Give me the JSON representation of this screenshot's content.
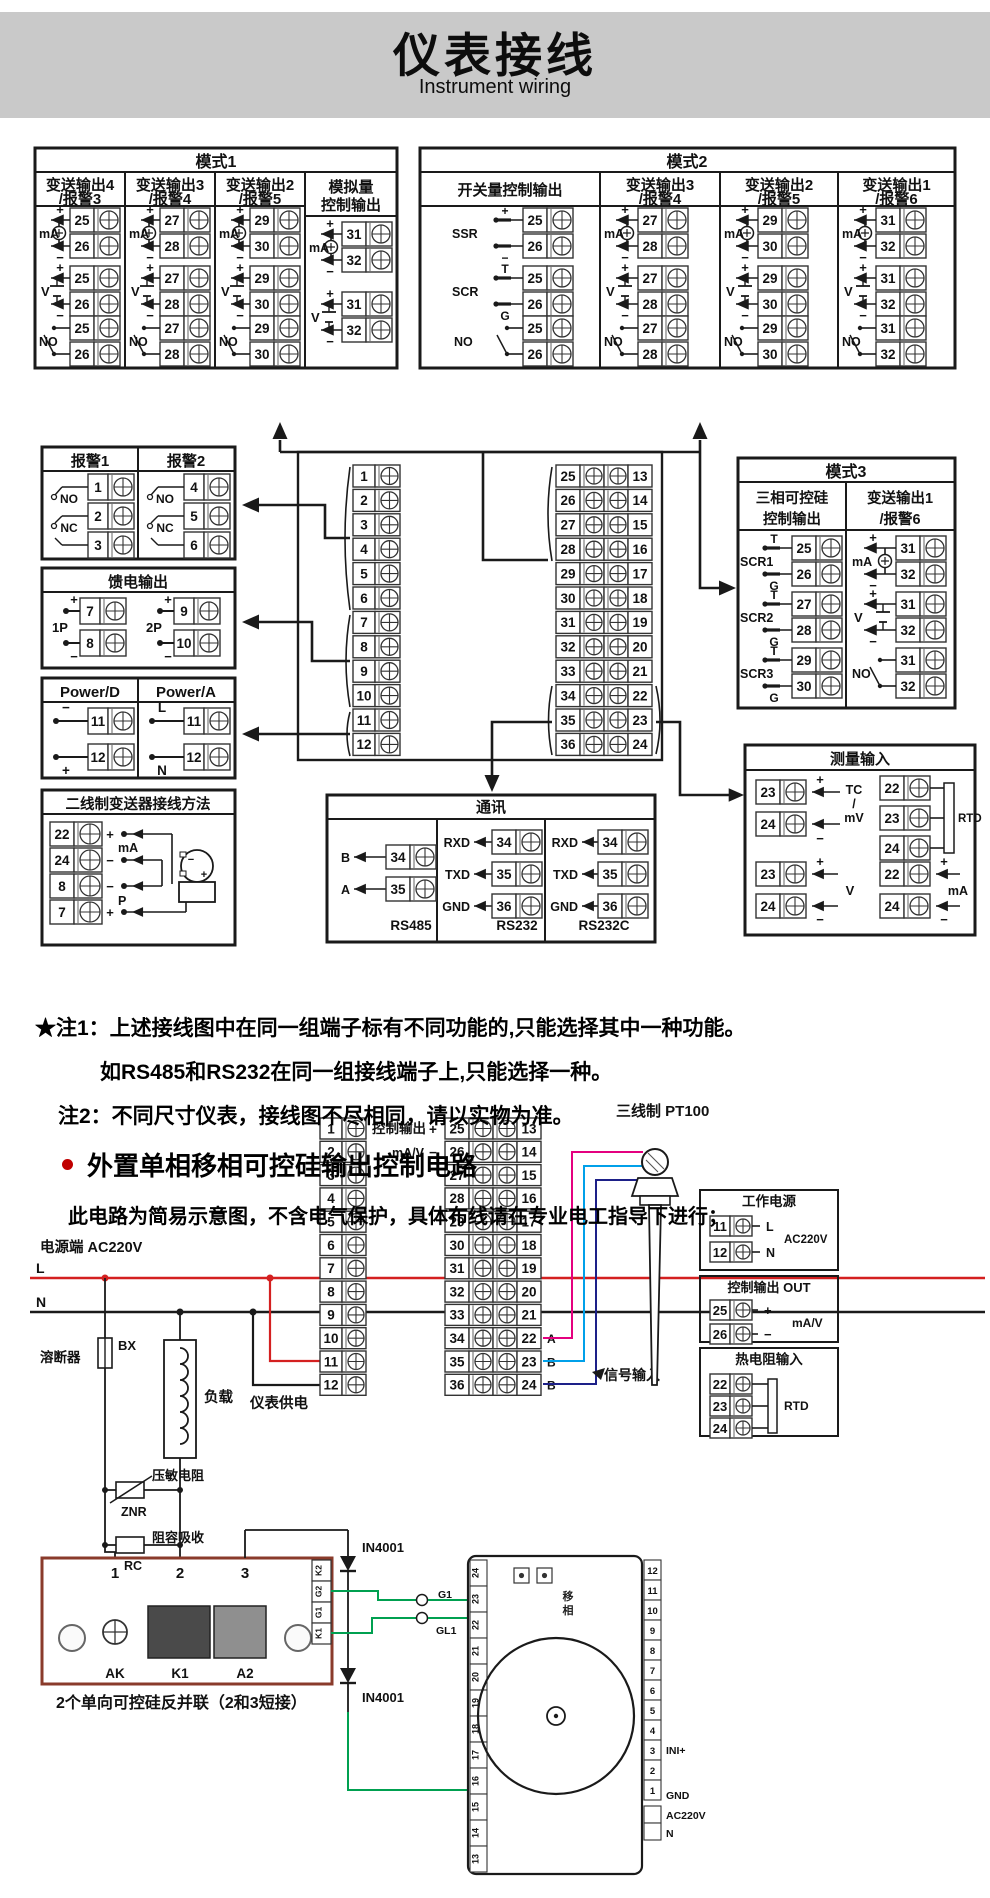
{
  "header": {
    "title": "仪表接线",
    "subtitle": "Instrument wiring"
  },
  "syms": {
    "plus": "+",
    "minus": "−",
    "t": "T",
    "g": "G"
  },
  "mode1": {
    "title": "模式1",
    "cols": [
      {
        "title": [
          "变送输出4",
          "/报警3"
        ],
        "groups": [
          {
            "sym": "mA",
            "t": [
              "25",
              "26"
            ]
          },
          {
            "sym": "V",
            "t": [
              "25",
              "26"
            ]
          },
          {
            "sym": "NO",
            "t": [
              "25",
              "26"
            ]
          }
        ]
      },
      {
        "title": [
          "变送输出3",
          "/报警4"
        ],
        "groups": [
          {
            "sym": "mA",
            "t": [
              "27",
              "28"
            ]
          },
          {
            "sym": "V",
            "t": [
              "27",
              "28"
            ]
          },
          {
            "sym": "NO",
            "t": [
              "27",
              "28"
            ]
          }
        ]
      },
      {
        "title": [
          "变送输出2",
          "/报警5"
        ],
        "groups": [
          {
            "sym": "mA",
            "t": [
              "29",
              "30"
            ]
          },
          {
            "sym": "V",
            "t": [
              "29",
              "30"
            ]
          },
          {
            "sym": "NO",
            "t": [
              "29",
              "30"
            ]
          }
        ]
      },
      {
        "title": [
          "模拟量",
          "控制输出"
        ],
        "groups": [
          {
            "sym": "mA",
            "t": [
              "31",
              "32"
            ]
          },
          {
            "sym": "V",
            "t": [
              "31",
              "32"
            ]
          }
        ]
      }
    ]
  },
  "mode2": {
    "title": "模式2",
    "cols": [
      {
        "title": [
          "开关量控制输出"
        ],
        "groups": [
          {
            "sym": "SSR",
            "t": [
              "25",
              "26"
            ]
          },
          {
            "sym": "SCR",
            "t": [
              "25",
              "26"
            ]
          },
          {
            "sym": "NO",
            "t": [
              "25",
              "26"
            ]
          }
        ]
      },
      {
        "title": [
          "变送输出3",
          "/报警4"
        ],
        "groups": [
          {
            "sym": "mA",
            "t": [
              "27",
              "28"
            ]
          },
          {
            "sym": "V",
            "t": [
              "27",
              "28"
            ]
          },
          {
            "sym": "NO",
            "t": [
              "27",
              "28"
            ]
          }
        ]
      },
      {
        "title": [
          "变送输出2",
          "/报警5"
        ],
        "groups": [
          {
            "sym": "mA",
            "t": [
              "29",
              "30"
            ]
          },
          {
            "sym": "V",
            "t": [
              "29",
              "30"
            ]
          },
          {
            "sym": "NO",
            "t": [
              "29",
              "30"
            ]
          }
        ]
      },
      {
        "title": [
          "变送输出1",
          "/报警6"
        ],
        "groups": [
          {
            "sym": "mA",
            "t": [
              "31",
              "32"
            ]
          },
          {
            "sym": "V",
            "t": [
              "31",
              "32"
            ]
          },
          {
            "sym": "NO",
            "t": [
              "31",
              "32"
            ]
          }
        ]
      }
    ]
  },
  "mode3": {
    "title": "模式3",
    "cols": [
      {
        "title": [
          "三相可控硅",
          "控制输出"
        ],
        "groups": [
          {
            "sym": "SCR1",
            "t": [
              "25",
              "26"
            ]
          },
          {
            "sym": "SCR2",
            "t": [
              "27",
              "28"
            ]
          },
          {
            "sym": "SCR3",
            "t": [
              "29",
              "30"
            ]
          }
        ]
      },
      {
        "title": [
          "变送输出1",
          "/报警6"
        ],
        "groups": [
          {
            "sym": "mA",
            "t": [
              "31",
              "32"
            ]
          },
          {
            "sym": "V",
            "t": [
              "31",
              "32"
            ]
          },
          {
            "sym": "NO",
            "t": [
              "31",
              "32"
            ]
          }
        ]
      }
    ]
  },
  "alarm": {
    "cols": [
      {
        "title": "报警1",
        "t": [
          "1",
          "2",
          "3"
        ]
      },
      {
        "title": "报警2",
        "t": [
          "4",
          "5",
          "6"
        ]
      }
    ],
    "no": "NO",
    "nc": "NC"
  },
  "feed": {
    "title": "馈电输出",
    "groups": [
      {
        "label": "1P",
        "t": [
          "7",
          "8"
        ]
      },
      {
        "label": "2P",
        "t": [
          "9",
          "10"
        ]
      }
    ]
  },
  "power": {
    "cols": [
      {
        "title": "Power/D",
        "rows": [
          [
            "−",
            "11"
          ],
          [
            "+",
            "12"
          ]
        ]
      },
      {
        "title": "Power/A",
        "rows": [
          [
            "L",
            "11"
          ],
          [
            "N",
            "12"
          ]
        ]
      }
    ]
  },
  "twowire": {
    "title": "二线制变送器接线方法",
    "rows": [
      [
        "22",
        "+"
      ],
      [
        "24",
        "−"
      ],
      [
        "8",
        "−"
      ],
      [
        "7",
        "+"
      ]
    ],
    "mid": [
      "mA",
      "P"
    ]
  },
  "block": {
    "left": [
      "1",
      "2",
      "3",
      "4",
      "5",
      "6",
      "7",
      "8",
      "9",
      "10",
      "11",
      "12"
    ],
    "inner": [
      "25",
      "26",
      "27",
      "28",
      "29",
      "30",
      "31",
      "32",
      "33",
      "34",
      "35",
      "36"
    ],
    "outer": [
      "13",
      "14",
      "15",
      "16",
      "17",
      "18",
      "19",
      "20",
      "21",
      "22",
      "23",
      "24"
    ]
  },
  "comm": {
    "title": "通讯",
    "cols": [
      {
        "rows": [
          [
            "B",
            "34"
          ],
          [
            "A",
            "35"
          ]
        ],
        "name": "RS485"
      },
      {
        "rows": [
          [
            "RXD",
            "34"
          ],
          [
            "TXD",
            "35"
          ],
          [
            "GND",
            "36"
          ]
        ],
        "name": "RS232"
      },
      {
        "rows": [
          [
            "RXD",
            "34"
          ],
          [
            "TXD",
            "35"
          ],
          [
            "GND",
            "36"
          ]
        ],
        "name": "RS232C"
      }
    ]
  },
  "meas": {
    "title": "测量输入",
    "tc": {
      "rows": [
        [
          "23",
          "+"
        ],
        [
          "24",
          "−"
        ]
      ],
      "label": [
        "TC",
        "/",
        "mV"
      ]
    },
    "rtd": {
      "t": [
        "22",
        "23",
        "24"
      ],
      "label": "RTD"
    },
    "v": {
      "rows": [
        [
          "23",
          "+"
        ],
        [
          "24",
          "−"
        ]
      ],
      "label": "V"
    },
    "ma": {
      "rows": [
        [
          "22",
          "+"
        ],
        [
          "24",
          "−"
        ]
      ],
      "label": "mA"
    }
  },
  "notes": {
    "n1": "★注1：上述接线图中在同一组端子标有不同功能的,只能选择其中一种功能。",
    "n1b": "如RS485和RS232在同一组接线端子上,只能选择一种。",
    "n2": "注2：不同尺寸仪表，接线图不尽相同，请以实物为准。"
  },
  "section": {
    "heading": "外置单相移相可控硅输出控制电路",
    "note": "此电路为简易示意图，不含电气保护，具体布线请在专业电工指导下进行；"
  },
  "circuit": {
    "srcLabel": "电源端  AC220V",
    "L": "L",
    "N": "N",
    "fuse": "溶断器",
    "fuseCode": "BX",
    "load": "负载",
    "znr": "压敏电阻",
    "znrCode": "ZNR",
    "rc": "阻容吸收",
    "rcCode": "RC",
    "meterPower": "仪表供电",
    "ctrlOut": "控制输出",
    "mav": "mA/V",
    "abb": [
      "A",
      "B",
      "B"
    ],
    "pt100": "三线制 PT100",
    "signal": "信号输入",
    "panels": [
      {
        "title": "工作电源",
        "rows": [
          [
            "11",
            "L"
          ],
          [
            "12",
            "N"
          ]
        ],
        "side": "AC220V"
      },
      {
        "title": "控制输出 OUT",
        "rows": [
          [
            "25",
            "+"
          ],
          [
            "26",
            "−"
          ]
        ],
        "side": "mA/V"
      },
      {
        "title": "热电阻输入",
        "rows": [
          [
            "22",
            ""
          ],
          [
            "23",
            ""
          ],
          [
            "24",
            ""
          ]
        ],
        "side": "RTD"
      }
    ],
    "diode": "IN4001",
    "scr": {
      "posts": [
        "1",
        "2",
        "3"
      ],
      "feet": [
        "AK",
        "K1",
        "A2"
      ],
      "strip": [
        "K2",
        "G2",
        "G1",
        "K1"
      ],
      "caption": "2个单向可控硅反并联（2和3短接）",
      "g1": "G1",
      "gl1": "GL1"
    },
    "device": {
      "leftNums": [
        "24",
        "23",
        "22",
        "21",
        "20",
        "19",
        "18",
        "17",
        "16",
        "15",
        "14",
        "13"
      ],
      "rightNums": [
        "12",
        "11",
        "10",
        "9",
        "8",
        "7",
        "6",
        "5",
        "4",
        "3",
        "2",
        "1"
      ],
      "ini": "INI+",
      "gnd": "GND",
      "ac": "AC220V",
      "n": "N",
      "inner": "移相"
    }
  },
  "colors": {
    "red": "#d42020",
    "green": "#00a050",
    "magenta": "#e4007f",
    "cyan": "#00a0e9",
    "blue": "#1d2088",
    "ink": "#1a1a1a",
    "banner": "#c9c9c9"
  }
}
